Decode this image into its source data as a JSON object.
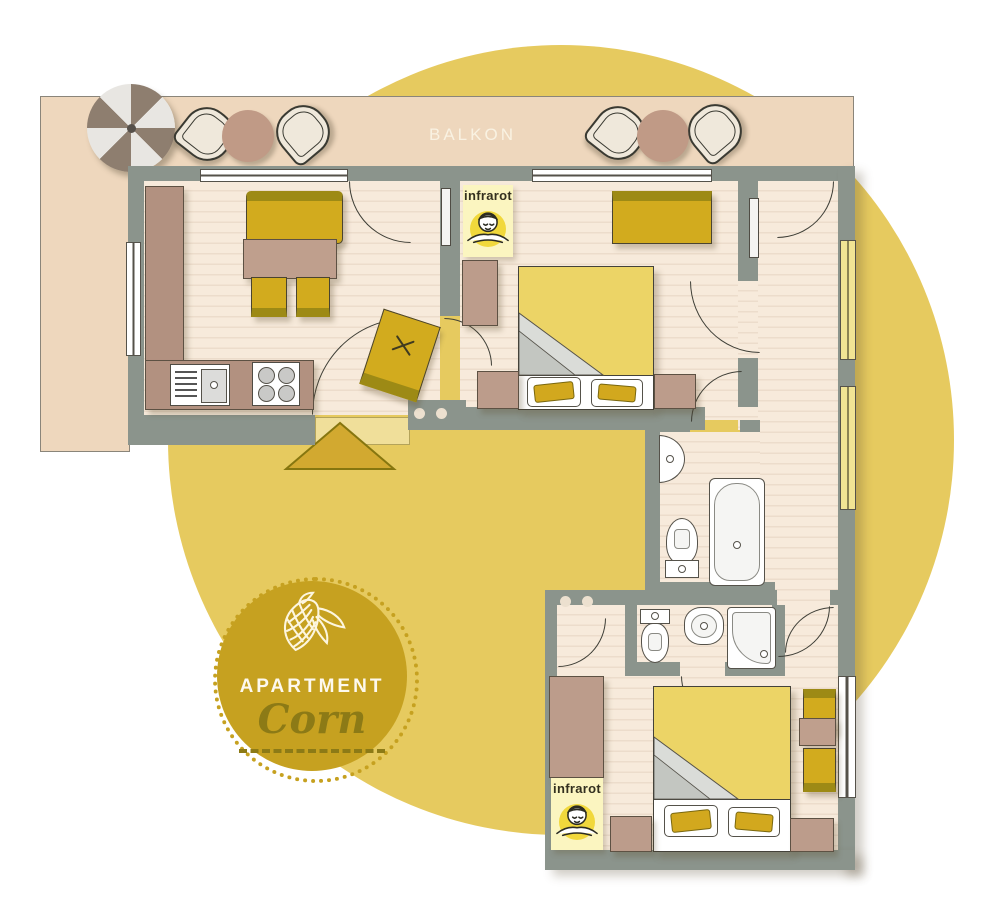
{
  "balcony": {
    "label": "BALKON"
  },
  "infrared_panel": {
    "label": "infrarot"
  },
  "badge": {
    "eyebrow": "APARTMENT",
    "name": "Corn"
  },
  "colors": {
    "background_circle": "#e6ca5f",
    "walls": "#8b948c",
    "balcony_floor": "#eed7bd",
    "room_floor": "#f7eadb",
    "furniture_yellow": "#d2ab1e",
    "furniture_yellow_dark": "#9d8a15",
    "duvet_yellow": "#ecd466",
    "furniture_brown": "#bf9f8d",
    "badge_gold": "#c6a120",
    "badge_text_dark": "#8c7a16",
    "infrared_bg": "#fbf5c0",
    "infrared_accent": "#f1d83c",
    "entry_arrow": "#d2a930"
  },
  "icons": {
    "umbrella": "parasol-icon",
    "balcony_chair": "shell-chair-icon",
    "sauna_person": "sauna-person-icon",
    "corn": "corn-icon",
    "entry": "entry-arrow-icon"
  }
}
